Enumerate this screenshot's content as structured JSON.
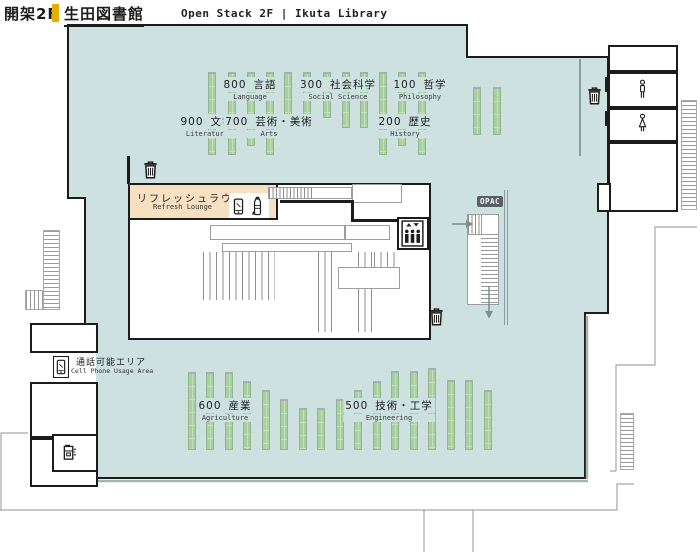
{
  "title": {
    "floor_jp": "開架2F",
    "library_jp": "生田図書館",
    "en": "Open Stack 2F | Ikuta Library"
  },
  "sections": [
    {
      "code": "800",
      "jp": "言語",
      "en": "Language"
    },
    {
      "code": "300",
      "jp": "社会科学",
      "en": "Social Science"
    },
    {
      "code": "100",
      "jp": "哲学",
      "en": "Philosophy"
    },
    {
      "code": "900",
      "jp": "文学",
      "en": "Literature"
    },
    {
      "code": "700",
      "jp": "芸術・美術",
      "en": "Arts"
    },
    {
      "code": "200",
      "jp": "歴史",
      "en": "History"
    },
    {
      "code": "600",
      "jp": "産業",
      "en": "Agriculture"
    },
    {
      "code": "500",
      "jp": "技術・工学",
      "en": "Engineering"
    }
  ],
  "areas": {
    "refresh_lounge": {
      "jp": "リフレッシュラウンジ",
      "en": "Refresh Lounge"
    },
    "cell_phone": {
      "jp": "通話可能エリア",
      "en": "Cell Phone Usage Area"
    },
    "opac_label": "OPAC"
  },
  "icons": {
    "trash": "trash-icon",
    "elevator": "elevator-icon",
    "restroom_male": "male-restroom-icon",
    "restroom_female": "female-restroom-icon",
    "phone": "mobile-phone-icon",
    "bottle": "drink-bottle-icon",
    "water_heater": "water-heater-icon",
    "arrow_right": "arrow-right-icon",
    "arrow_down": "arrow-down-icon"
  },
  "colors": {
    "floor": "#cde1e0",
    "shelf": "#a8cf9f",
    "shelfline": "#c6dfbc",
    "lounge": "#f7dfc1",
    "ink": "#1c1c1c",
    "gray": "#a3a3a3",
    "badge": "#585f66",
    "accent": "#e4af00"
  }
}
